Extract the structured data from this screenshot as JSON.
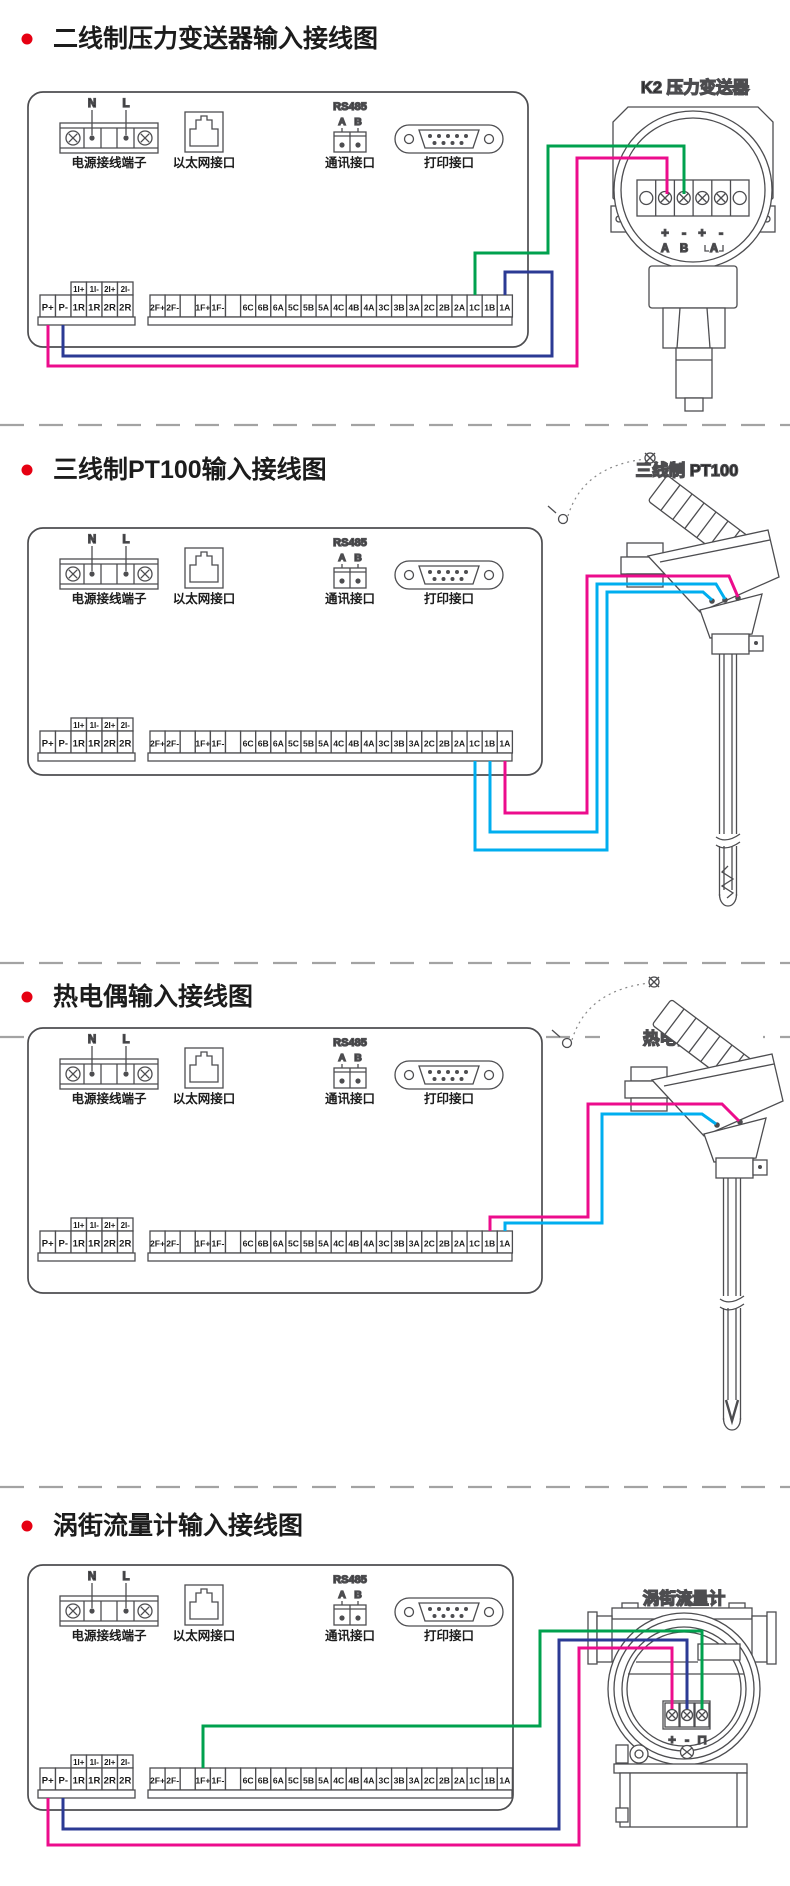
{
  "page": {
    "width": 790,
    "height": 1886,
    "background": "#ffffff"
  },
  "colors": {
    "page_bg": "#ffffff",
    "line": "#4d4d50",
    "title_text": "#1c1c1c",
    "bullet_red": "#e60012",
    "divider_gray": "#a3a3a3",
    "wire_pink": "#ec0c8c",
    "wire_blue": "#2b3a94",
    "wire_green": "#00a14e",
    "wire_cyan": "#00aeef"
  },
  "panel": {
    "power_n": "N",
    "power_l": "L",
    "power_label": "电源接线端子",
    "ethernet_label": "以太网接口",
    "rs485_label": "RS485",
    "rs485_a": "A",
    "rs485_b": "B",
    "comm_label": "通讯接口",
    "print_label": "打印接口",
    "aux_strip": [
      "1I+",
      "1I-",
      "2I+",
      "2I-"
    ],
    "left_strip": [
      "P+",
      "P-",
      "1R",
      "1R",
      "2R",
      "2R"
    ],
    "right_strip": [
      "2F+",
      "2F-",
      "",
      "1F+",
      "1F-",
      "",
      "6C",
      "6B",
      "6A",
      "5C",
      "5B",
      "5A",
      "4C",
      "4B",
      "4A",
      "3C",
      "3B",
      "3A",
      "2C",
      "2B",
      "2A",
      "1C",
      "1B",
      "1A"
    ]
  },
  "sections": [
    {
      "title": "二线制压力变送器输入接线图",
      "device_label": "K2 压力变送器",
      "transmitter_signs": [
        "+",
        "-",
        "+",
        "-"
      ],
      "transmitter_letters": [
        "A",
        "B",
        "A"
      ],
      "wires": [
        {
          "from": "P+",
          "to": "变送器端子",
          "color": "pink"
        },
        {
          "from": "1C",
          "to": "变送器端子",
          "color": "green"
        },
        {
          "from": "P-",
          "to": "1A",
          "color": "blue"
        }
      ]
    },
    {
      "title": "三线制PT100输入接线图",
      "device_label": "三线制 PT100",
      "wires": [
        {
          "from": "1C",
          "to": "PT100",
          "color": "cyan"
        },
        {
          "from": "1B",
          "to": "PT100",
          "color": "cyan"
        },
        {
          "from": "1A",
          "to": "PT100",
          "color": "pink"
        }
      ]
    },
    {
      "title": "热电偶输入接线图",
      "device_label": "热电偶 TC",
      "wires": [
        {
          "from": "1B",
          "to": "TC",
          "color": "pink"
        },
        {
          "from": "1A",
          "to": "TC",
          "color": "cyan"
        }
      ]
    },
    {
      "title": "涡街流量计输入接线图",
      "device_label": "涡街流量计",
      "flow_signs": [
        "+",
        "-",
        "⊓"
      ],
      "wires": [
        {
          "from": "1F+",
          "to": "脉冲端子",
          "color": "green"
        },
        {
          "from": "P-",
          "to": "-",
          "color": "blue"
        },
        {
          "from": "P+",
          "to": "+",
          "color": "pink"
        }
      ]
    }
  ]
}
